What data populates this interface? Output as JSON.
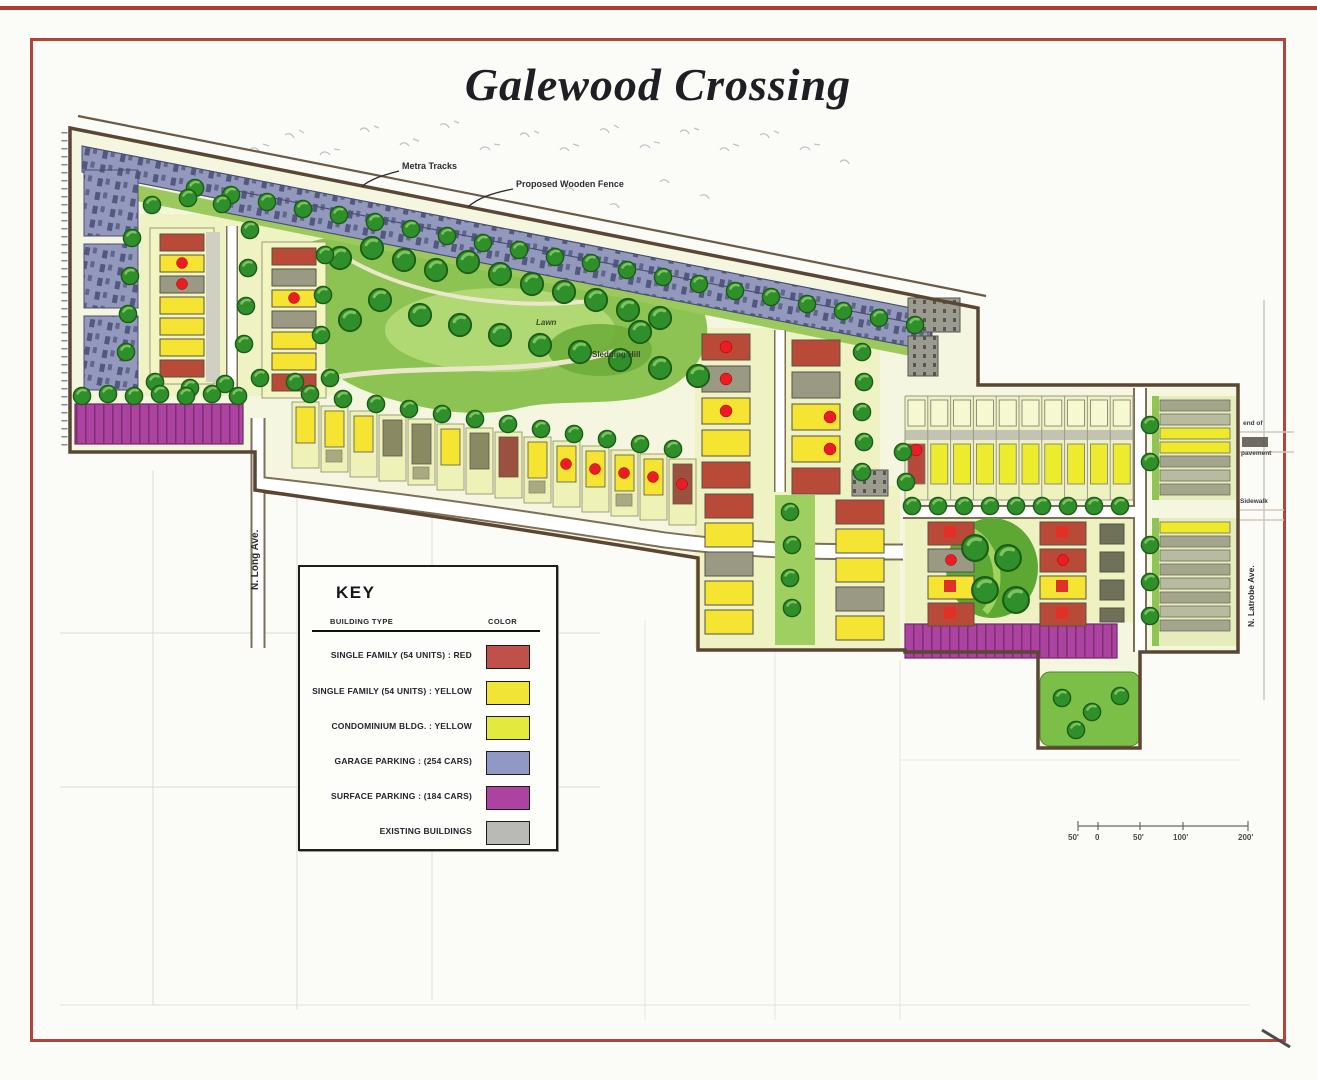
{
  "title": "Galewood Crossing",
  "legend": {
    "title": "KEY",
    "headers": {
      "type": "BUILDING TYPE",
      "color": "COLOR"
    },
    "rows": [
      {
        "label": "SINGLE FAMILY (54 UNITS) : RED",
        "swatch_style": "background:#c0504a"
      },
      {
        "label": "SINGLE FAMILY (54 UNITS) : YELLOW",
        "swatch_style": "background:#f2e437"
      },
      {
        "label": "CONDOMINIUM BLDG. : YELLOW",
        "swatch_style": "background:#e4e93e"
      },
      {
        "label": "GARAGE PARKING : (254 CARS)",
        "swatch_style": "background:#9099c4"
      },
      {
        "label": "SURFACE PARKING : (184 CARS)",
        "swatch_style": "background:#ad43a0"
      },
      {
        "label": "EXISTING BUILDINGS",
        "swatch_style": "background:#b9b9b5"
      }
    ]
  },
  "annotations": {
    "metra_tracks": "Metra Tracks",
    "proposed_fence": "Proposed Wooden Fence",
    "long_ave": "N. Long Ave.",
    "latrobe_ave": "N. Latrobe Ave.",
    "lawn": "Lawn",
    "hill": "Sledding Hill",
    "end_of_line1": "end of",
    "end_of_line2": "pavement",
    "sidewalk": "Sidewalk"
  },
  "scale_bar": {
    "labels": [
      "50'",
      "0",
      "50'",
      "100'",
      "200'"
    ]
  },
  "colors": {
    "single_family_red": "#c0504a",
    "single_family_yellow": "#f2e437",
    "condo_yellow": "#e4e93e",
    "garage_blue": "#9099c4",
    "surface_parking_purple": "#ad43a0",
    "existing_gray": "#b9b9b5",
    "park_green": "#8cc352",
    "border_red": "#b2453a"
  }
}
